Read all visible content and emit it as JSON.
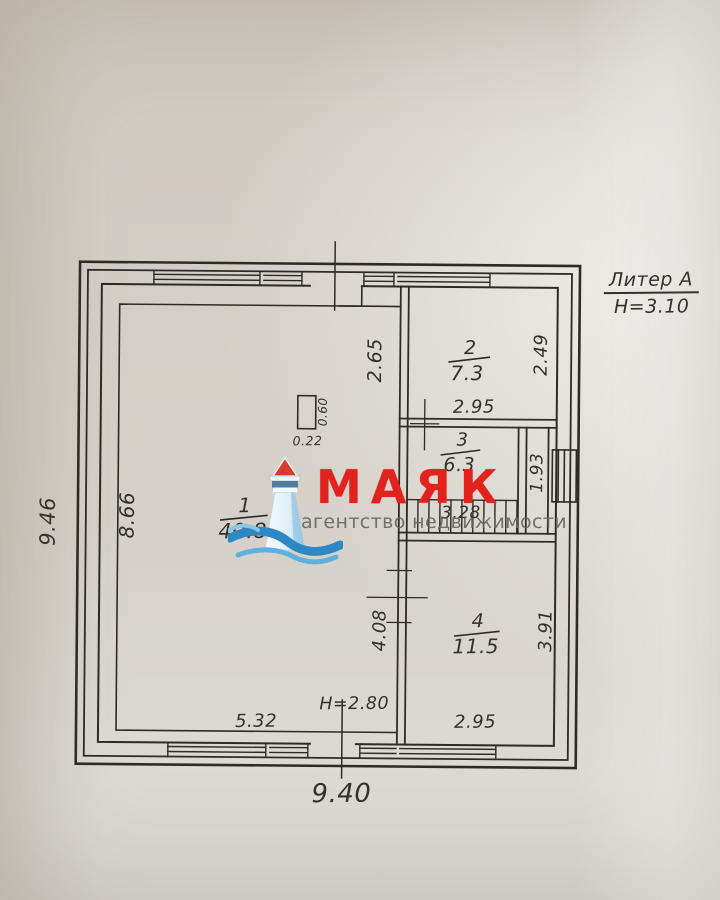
{
  "title_block": {
    "liter": "Литер А",
    "floor_height": "Н=3.10"
  },
  "rooms": [
    {
      "number": "1",
      "area": "40.8"
    },
    {
      "number": "2",
      "area": "7.3"
    },
    {
      "number": "3",
      "area": "6.3"
    },
    {
      "number": "4",
      "area": "11.5"
    }
  ],
  "dimensions": {
    "building_width_bottom": "9.40",
    "building_height_left": "9.46",
    "room1_left_wall": "8.66",
    "room1_bottom_width": "5.32",
    "ceiling_height_note": "Н=2.80",
    "partition_top": "2.65",
    "stove_depth": "0.60",
    "stove_width": "0.22",
    "room2_bottom_width": "2.95",
    "room2_right_height": "2.49",
    "hall_right_height": "1.93",
    "stairs_width": "3.28",
    "room4_left_height": "4.08",
    "room4_right_height": "3.91",
    "room4_bottom_width": "2.95"
  },
  "watermark": {
    "brand": "МАЯК",
    "tagline": "агентство недвижимости"
  },
  "colors": {
    "brand_red": "#e2231d",
    "ink": "#34312c",
    "paper": "#d3cec5",
    "watermark_gray": "#686662"
  }
}
